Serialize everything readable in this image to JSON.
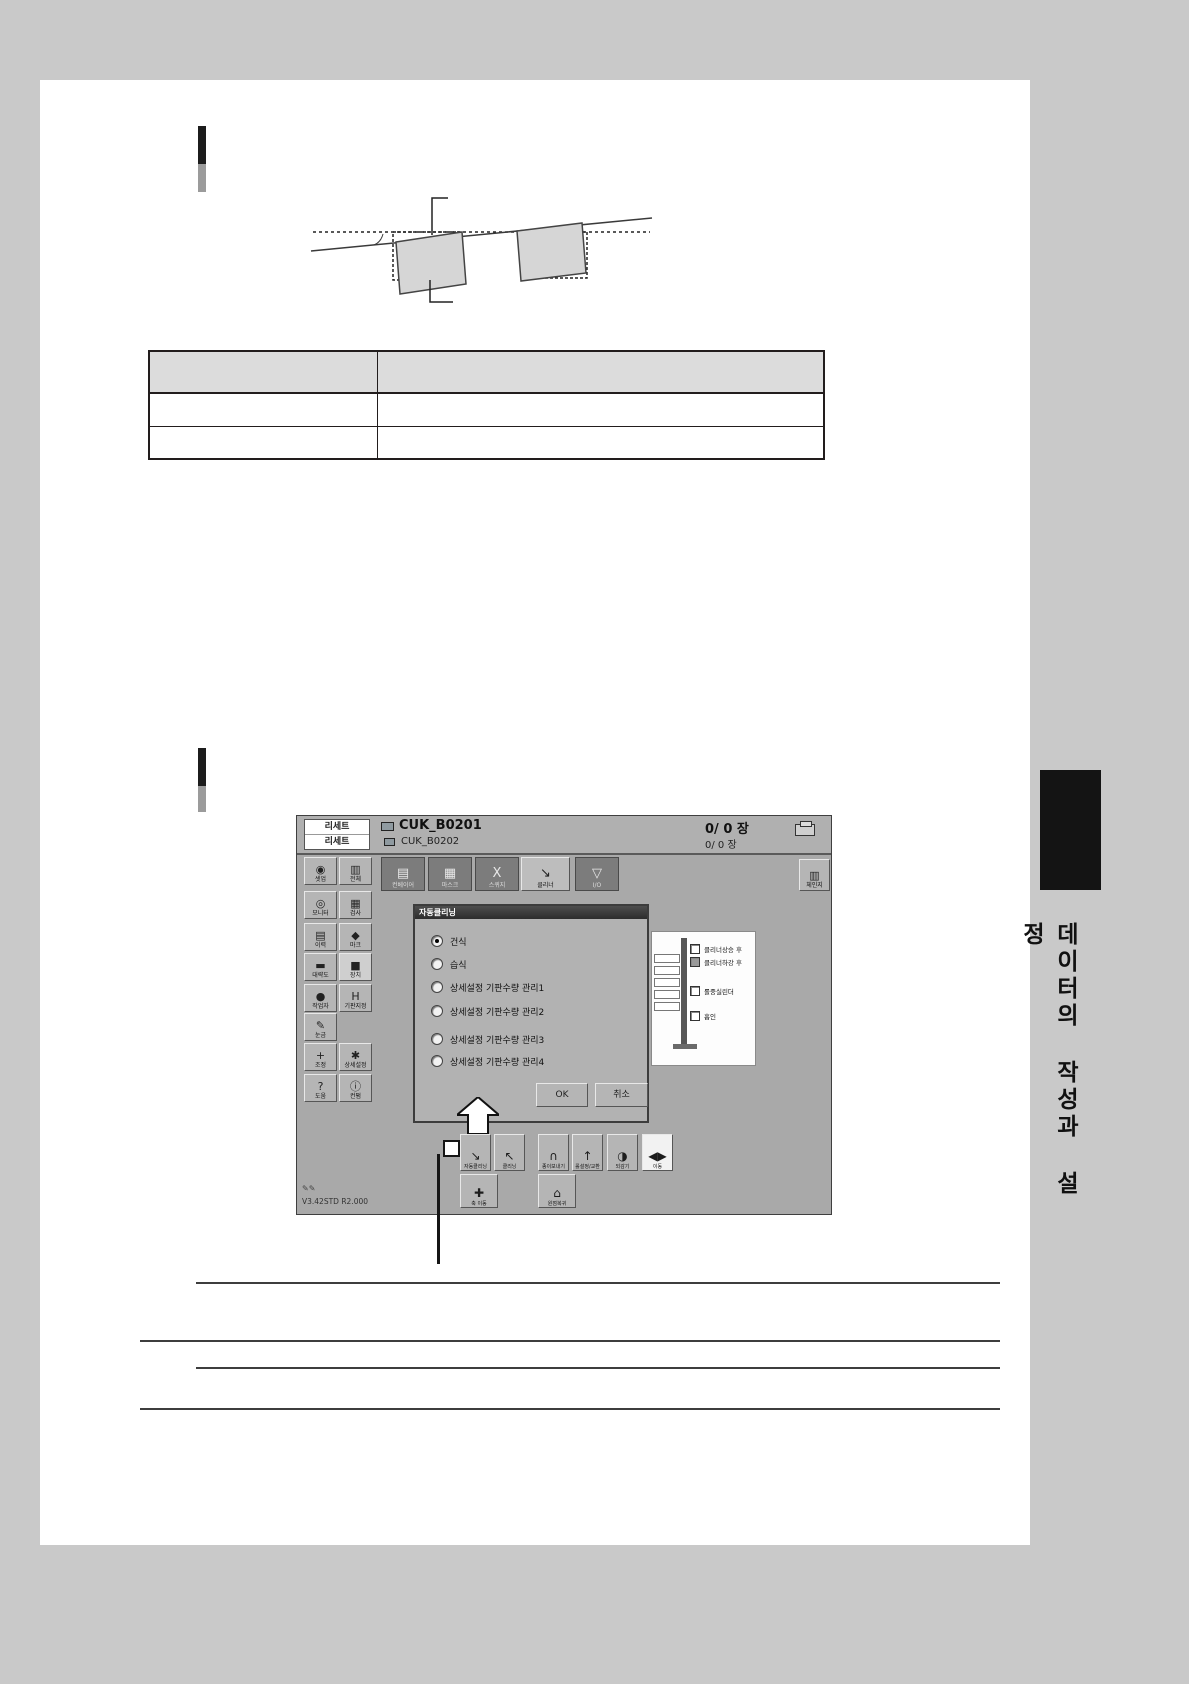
{
  "colors": {
    "page_bg": "#c9c9c9",
    "paper": "#ffffff",
    "screen_bg": "#a9a9a9",
    "tab_dark": "#7c7c7c",
    "dialog_title": "#3c3c3c"
  },
  "side_tab_label": "데이터의 작성과 설정",
  "shot": {
    "reset1": "리세트",
    "reset2": "리세트",
    "job1": "CUK_B0201",
    "job2": "CUK_B0202",
    "count1": "0/ 0 장",
    "count2": "0/ 0 장",
    "sidebar": {
      "items": [
        {
          "label": "셋업"
        },
        {
          "label": "전체"
        },
        {
          "label": "모니터"
        },
        {
          "label": "검사"
        },
        {
          "label": "이력"
        },
        {
          "label": "마크"
        },
        {
          "label": "대략도"
        },
        {
          "label": "장치"
        },
        {
          "label": "작업자"
        },
        {
          "label": "기판지정"
        },
        {
          "label": "눈금"
        },
        {
          "label": "조정"
        },
        {
          "label": "상세설정"
        },
        {
          "label": "도움"
        },
        {
          "label": "컨펌"
        }
      ]
    },
    "tabs": [
      {
        "label": "컨베이어"
      },
      {
        "label": "마스크"
      },
      {
        "label": "스퀴지"
      },
      {
        "label": "클리너",
        "selected": true
      },
      {
        "label": "I/O"
      }
    ],
    "change_button": "체인지",
    "dialog": {
      "title": "자동클리닝",
      "selected_index": 0,
      "options": [
        {
          "label": "건식"
        },
        {
          "label": "습식"
        },
        {
          "label": "상세설정 기판수량 관리1"
        },
        {
          "label": "상세설정 기판수량 관리2"
        },
        {
          "label": "상세설정 기판수량 관리3"
        },
        {
          "label": "상세설정 기판수량 관리4"
        }
      ],
      "ok": "OK",
      "cancel": "취소"
    },
    "schematic": {
      "checkboxes": [
        {
          "label": "클리너상승 후"
        },
        {
          "label": "클리너하강 후",
          "filled": true
        },
        {
          "label": "롤중실린더"
        },
        {
          "label": "흡인"
        }
      ]
    },
    "toolbar_row1": [
      {
        "label": "자동클리닝"
      },
      {
        "label": "클리닝"
      },
      {
        "label": "종이보내기"
      },
      {
        "label": "롤설정/교환"
      },
      {
        "label": "되감기"
      },
      {
        "label": "이동",
        "selected": true
      }
    ],
    "toolbar_row2": [
      {
        "label": "축 이동"
      },
      {
        "label": "원점복귀"
      }
    ],
    "version": "V3.42STD R2.000"
  }
}
